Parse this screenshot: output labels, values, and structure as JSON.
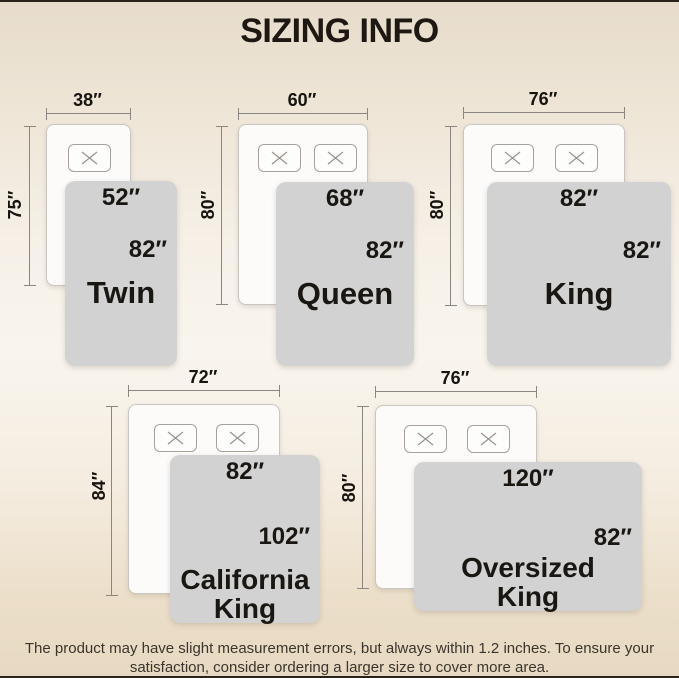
{
  "title": "SIZING INFO",
  "colors": {
    "background_beige": "#e7dccb",
    "background_light": "#f9f5ee",
    "cover_gray": "#d2d2d3",
    "bed_white": "#fcfbfa",
    "text_dark": "#1a1712",
    "measure_gray": "#8b8780",
    "edge_dark": "#29231c"
  },
  "diagrams": [
    {
      "name": "Twin",
      "name_lines": [
        "Twin"
      ],
      "bed_width": "38″",
      "bed_height": "75″",
      "cover_width": "52″",
      "cover_height": "82″",
      "pillow_count": 1
    },
    {
      "name": "Queen",
      "name_lines": [
        "Queen"
      ],
      "bed_width": "60″",
      "bed_height": "80″",
      "cover_width": "68″",
      "cover_height": "82″",
      "pillow_count": 2
    },
    {
      "name": "King",
      "name_lines": [
        "King"
      ],
      "bed_width": "76″",
      "bed_height": "80″",
      "cover_width": "82″",
      "cover_height": "82″",
      "pillow_count": 2
    },
    {
      "name": "California King",
      "name_lines": [
        "California",
        "King"
      ],
      "bed_width": "72″",
      "bed_height": "84″",
      "cover_width": "82″",
      "cover_height": "102″",
      "pillow_count": 2
    },
    {
      "name": "Oversized King",
      "name_lines": [
        "Oversized",
        "King"
      ],
      "bed_width": "76″",
      "bed_height": "80″",
      "cover_width": "120″",
      "cover_height": "82″",
      "pillow_count": 2
    }
  ],
  "footer": {
    "line1": "The product may have slight measurement errors, but always within 1.2 inches. To ensure your",
    "line2": "satisfaction, consider ordering a larger size to cover more area."
  }
}
